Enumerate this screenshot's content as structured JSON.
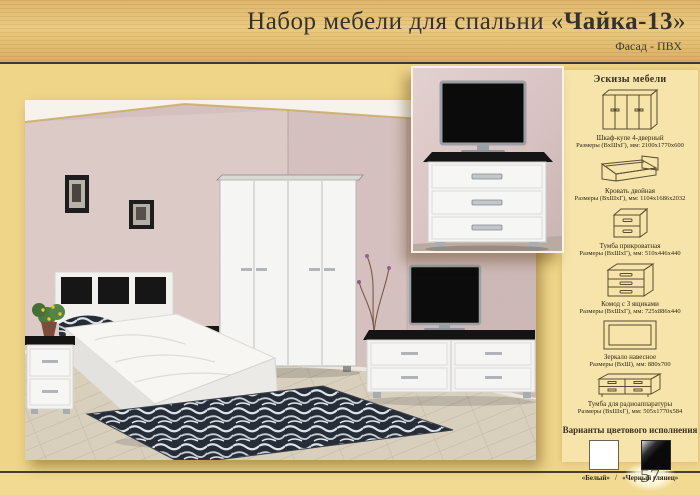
{
  "page": {
    "title_prefix": "Набор мебели для спальни ",
    "title_quote_open": "«",
    "title_name": "Чайка-13",
    "title_quote_close": "»",
    "subtitle": "Фасад - ПВХ",
    "page_number": "57"
  },
  "sketches_panel": {
    "header": "Эскизы мебели",
    "items": [
      {
        "icon": "wardrobe-sketch-icon",
        "name": "Шкаф-купе 4-дверный",
        "dimensions": "Размеры (ВхШхГ), мм: 2100х1770х600"
      },
      {
        "icon": "bed-sketch-icon",
        "name": "Кровать двойная",
        "dimensions": "Размеры (ВхШхГ), мм: 1104х1686х2032"
      },
      {
        "icon": "nightstand-sketch-icon",
        "name": "Тумба прикроватная",
        "dimensions": "Размеры (ВхШхГ), мм: 510х446х440"
      },
      {
        "icon": "chest-sketch-icon",
        "name": "Комод с 3 ящиками",
        "dimensions": "Размеры (ВхШхГ), мм: 725х886х440"
      },
      {
        "icon": "mirror-sketch-icon",
        "name": "Зеркало навесное",
        "dimensions": "Размеры (ВхШ), мм: 880х700"
      },
      {
        "icon": "tv-stand-sketch-icon",
        "name": "Тумба для радиоаппаратуры",
        "dimensions": "Размеры (ВхШхГ), мм: 505х1770х584"
      }
    ]
  },
  "colors_panel": {
    "header": "Варианты цветового исполнения",
    "separator": "/",
    "options": [
      {
        "label": "«Белый»",
        "hex": "#ffffff"
      },
      {
        "label": "«Черный глянец»",
        "hex": "#0a0a0a"
      }
    ]
  }
}
